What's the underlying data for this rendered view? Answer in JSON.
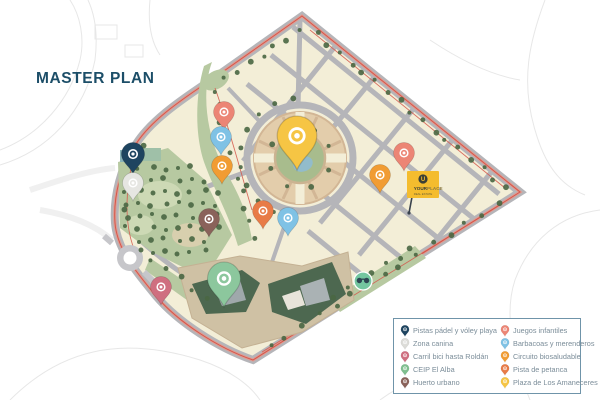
{
  "page": {
    "title": "MASTER PLAN",
    "title_color": "#1c4e68"
  },
  "flag": {
    "line1": "YOUR",
    "line2": "PLACE",
    "tagline": "REAL ESTATE",
    "bg": "#f4bc2e",
    "mark": "U"
  },
  "legend": {
    "columns": [
      {
        "items": [
          {
            "label": "Pistas pádel y vóley playa",
            "color": "#1e4460"
          },
          {
            "label": "Zona canina",
            "color": "#dcdcd8"
          },
          {
            "label": "Carril bici hasta Roldán",
            "color": "#cf6f80"
          },
          {
            "label": "CEIP El Alba",
            "color": "#7fbf8f"
          },
          {
            "label": "Huerto urbano",
            "color": "#8a625a"
          }
        ]
      },
      {
        "items": [
          {
            "label": "Juegos infantiles",
            "color": "#ec8575"
          },
          {
            "label": "Barbacoas y merenderos",
            "color": "#7fc2e5"
          },
          {
            "label": "Circuito biosaludable",
            "color": "#f19c33"
          },
          {
            "label": "Pista de petanca",
            "color": "#e87b47"
          },
          {
            "label": "Plaza de Los Amaneceres",
            "color": "#f6c544"
          }
        ]
      }
    ]
  },
  "map": {
    "pins": [
      {
        "id": "pistas-padel",
        "label": "Pistas pádel y vóley playa",
        "color": "#1e4460",
        "x": 133,
        "y": 174,
        "scale": 1.05
      },
      {
        "id": "zona-canina",
        "label": "Zona canina",
        "color": "#e6e6e2",
        "x": 133,
        "y": 201,
        "scale": 0.95
      },
      {
        "id": "juegos-1",
        "label": "Juegos infantiles",
        "color": "#ec8575",
        "x": 224,
        "y": 130,
        "scale": 0.95
      },
      {
        "id": "barbacoas-1",
        "label": "Barbacoas y merenderos",
        "color": "#7fc2e5",
        "x": 221,
        "y": 155,
        "scale": 0.95
      },
      {
        "id": "circuito-1",
        "label": "Circuito biosaludable",
        "color": "#f19c33",
        "x": 222,
        "y": 184,
        "scale": 0.95
      },
      {
        "id": "huerto-urbano",
        "label": "Huerto urbano",
        "color": "#8a625a",
        "x": 209,
        "y": 237,
        "scale": 0.95
      },
      {
        "id": "petanca-1",
        "label": "Pista de petanca",
        "color": "#e87b47",
        "x": 263,
        "y": 229,
        "scale": 0.95
      },
      {
        "id": "barbacoas-2",
        "label": "Barbacoas y merenderos",
        "color": "#7fc2e5",
        "x": 288,
        "y": 236,
        "scale": 0.95
      },
      {
        "id": "plaza-amaneceres",
        "label": "Plaza de Los Amaneceres",
        "color": "#f6c544",
        "x": 297,
        "y": 170,
        "scale": 1.8
      },
      {
        "id": "juegos-2",
        "label": "Juegos infantiles",
        "color": "#ec8575",
        "x": 404,
        "y": 171,
        "scale": 0.95
      },
      {
        "id": "circuito-2",
        "label": "Circuito biosaludable",
        "color": "#f19c33",
        "x": 380,
        "y": 193,
        "scale": 0.95
      },
      {
        "id": "carril-bici",
        "label": "Carril bici hasta Roldán",
        "color": "#cf6f80",
        "x": 161,
        "y": 305,
        "scale": 0.95
      },
      {
        "id": "ceip-el-alba",
        "label": "CEIP El Alba",
        "color": "#8cc79d",
        "x": 224,
        "y": 307,
        "scale": 1.5
      }
    ]
  }
}
